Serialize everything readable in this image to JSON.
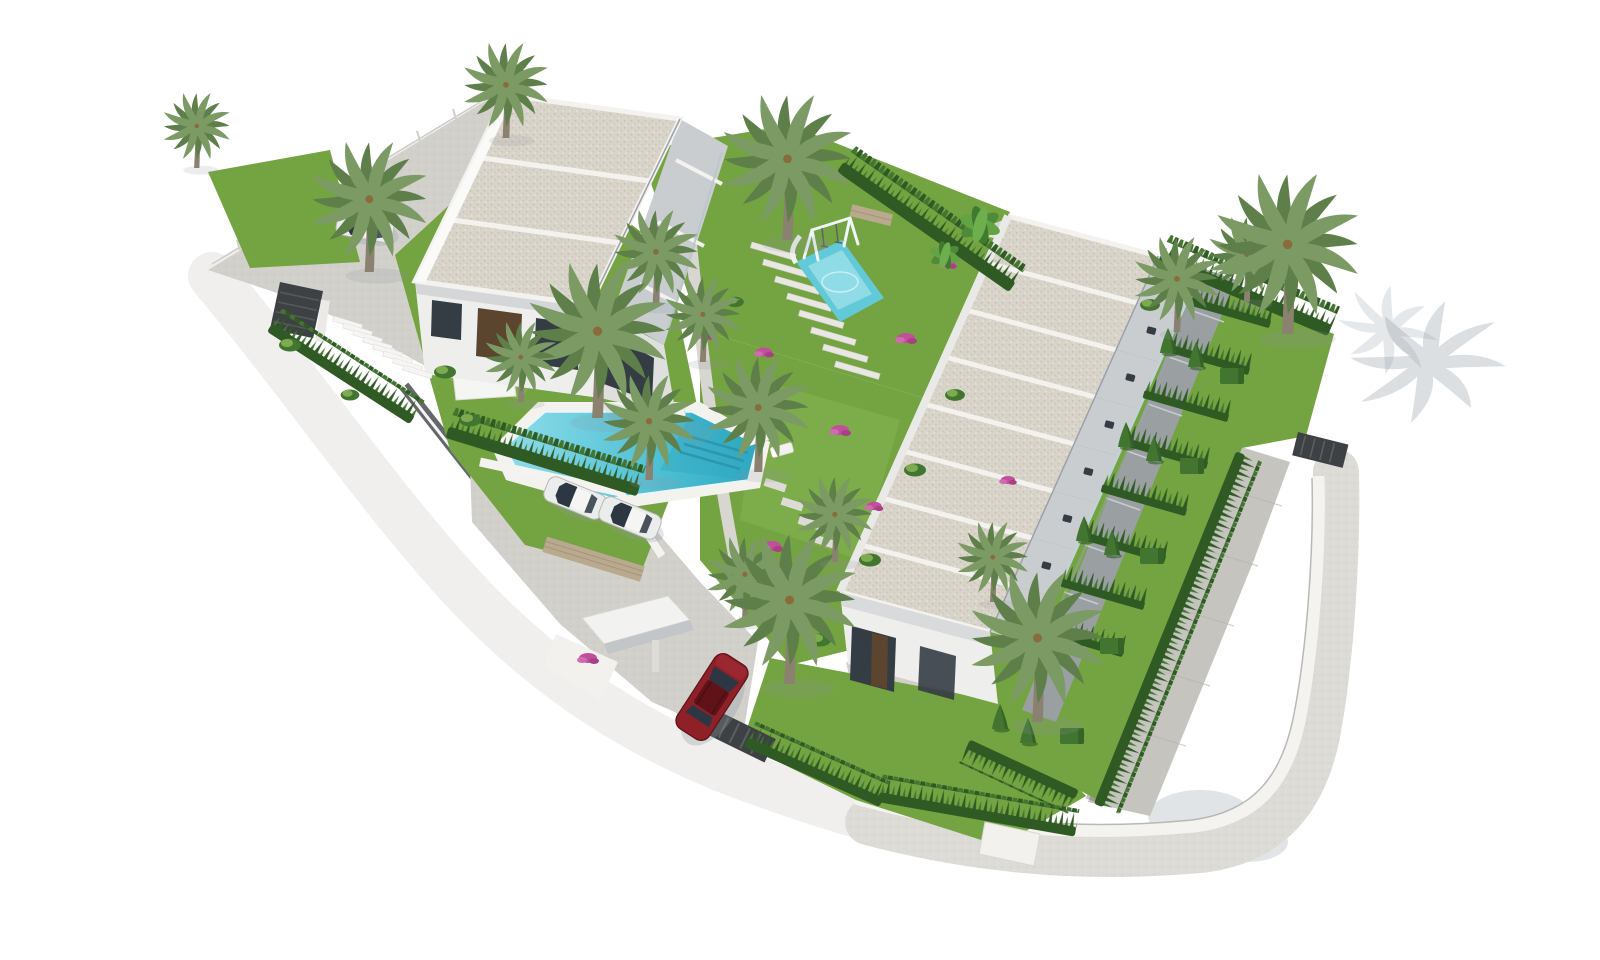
{
  "scene": {
    "type": "aerial 3d architectural render",
    "subject": "residential development with a 3-unit villa block, an 8-unit townhouse row, communal pool, playground, gardens, parking and gated entrance",
    "background": "#ffffff"
  },
  "palette": {
    "background": "#ffffff",
    "sidewalk": "#dcdbd6",
    "sidewalk_edge": "#c2c1bc",
    "pavement": "#d1d0cb",
    "pavement_dark": "#c5c4bf",
    "wall_white": "#f3f2ef",
    "wall_shade": "#dddcd8",
    "retaining_dark": "#64686c",
    "roof_base": "#d9d4ca",
    "roof_speck": "#c2bbad",
    "roof_beam": "#f3f2ef",
    "roof_edge": "#9aa0a8",
    "facade": "#eeefed",
    "facade_shade": "#dfe0de",
    "terrace_gray": "#c9cdd0",
    "patio_gray": "#9aa0a2",
    "glass_dark": "#343c44",
    "door_brown": "#5c452e",
    "balustrade": "#c2d2d8",
    "grass_main": "#74a341",
    "grass_light": "#8db957",
    "grass_dark": "#5b8a31",
    "hedge_dark": "#2f5a23",
    "hedge_mid": "#417530",
    "palm_frond": "#7c9a64",
    "palm_frond_dark": "#5e7f49",
    "palm_trunk": "#8a8170",
    "pool_light": "#8fdce8",
    "pool_deep": "#2fa9c1",
    "pool_deck": "#f3f2ee",
    "splash": "#62c9d9",
    "car_white": "#ebecec",
    "car_glass": "#2d3744",
    "car_red": "#8e2027",
    "car_red_dark": "#5f1218",
    "fence_dark": "#3d4143",
    "shadow": "#8e98a2",
    "flower_pink": "#c0509b",
    "stone_wall": "#b9a98e"
  },
  "site": {
    "perimeter": "curved white wall with dark metal fence segments and cypress hedges",
    "sidewalk": "light gray band around lower and right boundary",
    "entrance": {
      "gate": "dark metal gate",
      "canopy": "white entrance canopy",
      "vehicle": "red SUV entering"
    },
    "staircase": "white exterior stairs at upper-left wall"
  },
  "buildings": {
    "villa_block": {
      "position": "upper-left",
      "units": 3,
      "roof": "stepped flat gravel roofs",
      "features": [
        "white facades",
        "dark glazing",
        "balconies with glass rails"
      ]
    },
    "townhouse_row": {
      "position": "right",
      "units": 8,
      "roof": "stepped flat gravel roofs",
      "features": [
        "roof terraces with furniture",
        "rear patios",
        "private hedge gardens"
      ]
    }
  },
  "amenities": {
    "pool": {
      "position": "center-left",
      "water": "turquoise",
      "features": [
        "white deck",
        "entry steps",
        "sun loungers",
        "shade canopies"
      ]
    },
    "playground": {
      "position": "upper-center",
      "features": [
        "swing set",
        "blue splash pad",
        "slide"
      ]
    },
    "parking": {
      "white_cars": 2
    },
    "upper_driveway": {
      "white_cars": 1
    }
  },
  "vegetation": {
    "palm_trees": 18,
    "cone_bushes": 10,
    "box_hedges": 5,
    "bougainvillea_clusters": 10,
    "cypress_hedge_rows": 9,
    "stepped_garden_paths": 3
  }
}
